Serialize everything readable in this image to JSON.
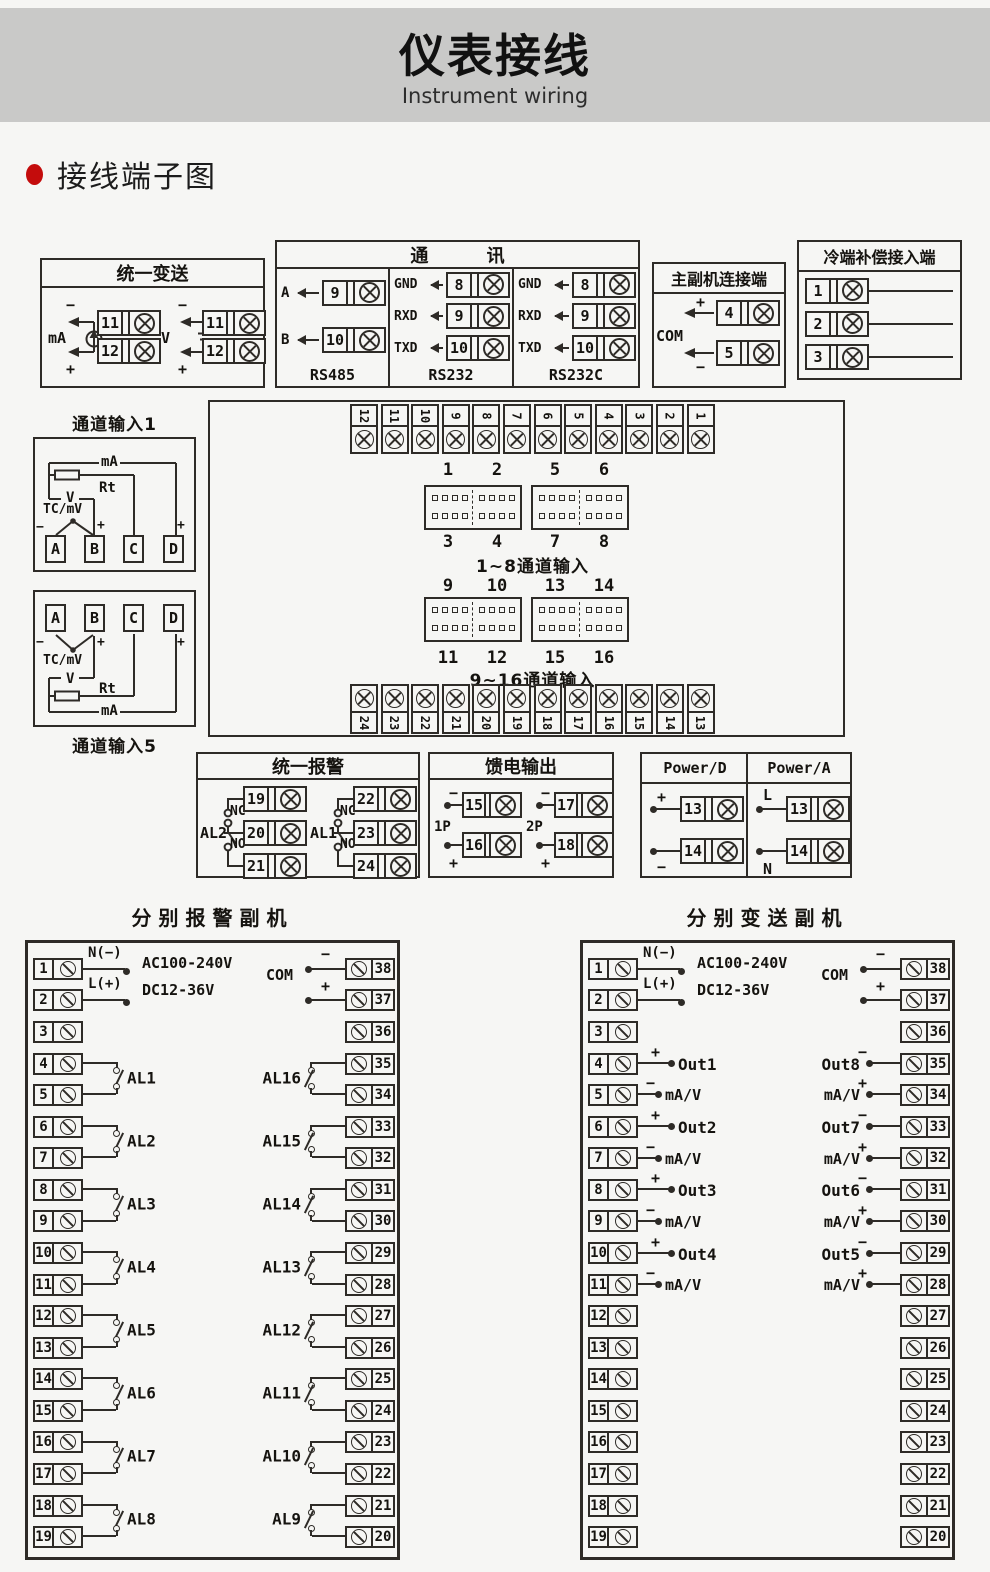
{
  "page": {
    "title": "仪表接线",
    "subtitle": "Instrument wiring",
    "section": "接线端子图"
  },
  "ut": {
    "title": "统一变送",
    "ma": "mA",
    "v": "V",
    "minus": "−",
    "plus": "+",
    "ma_terminals": [
      "11",
      "12"
    ],
    "v_terminals": [
      "11",
      "12"
    ]
  },
  "comm": {
    "title": "通 讯",
    "columns": [
      {
        "name": "RS485",
        "rows": [
          {
            "label": "A",
            "num": "9"
          },
          {
            "label": "B",
            "num": "10"
          }
        ]
      },
      {
        "name": "RS232",
        "rows": [
          {
            "label": "GND",
            "num": "8"
          },
          {
            "label": "RXD",
            "num": "9"
          },
          {
            "label": "TXD",
            "num": "10"
          }
        ]
      },
      {
        "name": "RS232C",
        "rows": [
          {
            "label": "GND",
            "num": "8"
          },
          {
            "label": "RXD",
            "num": "9"
          },
          {
            "label": "TXD",
            "num": "10"
          }
        ]
      }
    ]
  },
  "ms": {
    "title": "主副机连接端",
    "com": "COM",
    "plus": "+",
    "minus": "−",
    "terminals": [
      "4",
      "5"
    ]
  },
  "cc": {
    "title": "冷端补偿接入端",
    "rows": [
      {
        "label": "黑线",
        "num": "1"
      },
      {
        "label": "黄线",
        "num": "2"
      },
      {
        "label": "红线",
        "num": "3"
      }
    ]
  },
  "mb": {
    "top_strip": [
      "12",
      "11",
      "10",
      "9",
      "8",
      "7",
      "6",
      "5",
      "4",
      "3",
      "2",
      "1"
    ],
    "bottom_strip": [
      "24",
      "23",
      "22",
      "21",
      "20",
      "19",
      "18",
      "17",
      "16",
      "15",
      "14",
      "13"
    ],
    "upper": {
      "top_nums": [
        "1",
        "2",
        "5",
        "6"
      ],
      "bottom_nums": [
        "3",
        "4",
        "7",
        "8"
      ],
      "caption": "1~8通道输入"
    },
    "lower": {
      "top_nums": [
        "9",
        "10",
        "13",
        "14"
      ],
      "bottom_nums": [
        "11",
        "12",
        "15",
        "16"
      ],
      "caption": "9~16通道输入"
    }
  },
  "ch1": {
    "title": "通道输入1",
    "ma": "mA",
    "rt": "Rt",
    "v": "V",
    "tc": "TC/mV",
    "minus": "−",
    "plus": "+",
    "terminals": [
      "A",
      "B",
      "C",
      "D"
    ]
  },
  "ch5": {
    "title": "通道输入5",
    "ma": "mA",
    "rt": "Rt",
    "v": "V",
    "tc": "TC/mV",
    "minus": "−",
    "plus": "+",
    "terminals": [
      "A",
      "B",
      "C",
      "D"
    ]
  },
  "ua": {
    "title": "统一报警",
    "groups": [
      {
        "label": "AL2",
        "nc": "NC",
        "no": "NO",
        "terminals": [
          "19",
          "20",
          "21"
        ]
      },
      {
        "label": "AL1",
        "nc": "NC",
        "no": "NO",
        "terminals": [
          "22",
          "23",
          "24"
        ]
      }
    ]
  },
  "fo": {
    "title": "馈电输出",
    "minus": "−",
    "plus": "+",
    "groups": [
      {
        "label": "1P",
        "terminals": [
          "15",
          "16"
        ]
      },
      {
        "label": "2P",
        "terminals": [
          "17",
          "18"
        ]
      }
    ]
  },
  "pw": {
    "d_title": "Power/D",
    "a_title": "Power/A",
    "d": {
      "top_sign": "+",
      "bottom_sign": "−",
      "nums": [
        "13",
        "14"
      ]
    },
    "a": {
      "top_sign": "L",
      "bottom_sign": "N",
      "nums": [
        "13",
        "14"
      ]
    }
  },
  "as": {
    "title": "分别报警副机",
    "left_terminals": [
      "1",
      "2",
      "3",
      "4",
      "5",
      "6",
      "7",
      "8",
      "9",
      "10",
      "11",
      "12",
      "13",
      "14",
      "15",
      "16",
      "17",
      "18",
      "19"
    ],
    "right_terminals": [
      "38",
      "37",
      "36",
      "35",
      "34",
      "33",
      "32",
      "31",
      "30",
      "29",
      "28",
      "27",
      "26",
      "25",
      "24",
      "23",
      "22",
      "21",
      "20"
    ],
    "n": "N(−)",
    "l": "L(+)",
    "ac": "AC100-240V",
    "dc": "DC12-36V",
    "com": "COM",
    "minus": "−",
    "plus": "+",
    "left_alarms": [
      "AL1",
      "AL2",
      "AL3",
      "AL4",
      "AL5",
      "AL6",
      "AL7",
      "AL8"
    ],
    "right_alarms": [
      "AL16",
      "AL15",
      "AL14",
      "AL13",
      "AL12",
      "AL11",
      "AL10",
      "AL9"
    ]
  },
  "ts": {
    "title": "分别变送副机",
    "left_terminals": [
      "1",
      "2",
      "3",
      "4",
      "5",
      "6",
      "7",
      "8",
      "9",
      "10",
      "11",
      "12",
      "13",
      "14",
      "15",
      "16",
      "17",
      "18",
      "19"
    ],
    "right_terminals": [
      "38",
      "37",
      "36",
      "35",
      "34",
      "33",
      "32",
      "31",
      "30",
      "29",
      "28",
      "27",
      "26",
      "25",
      "24",
      "23",
      "22",
      "21",
      "20"
    ],
    "n": "N(−)",
    "l": "L(+)",
    "ac": "AC100-240V",
    "dc": "DC12-36V",
    "com": "COM",
    "minus": "−",
    "plus": "+",
    "left_outputs": [
      {
        "name": "Out1",
        "sub": "mA/V"
      },
      {
        "name": "Out2",
        "sub": "mA/V"
      },
      {
        "name": "Out3",
        "sub": "mA/V"
      },
      {
        "name": "Out4",
        "sub": "mA/V"
      }
    ],
    "right_outputs": [
      {
        "name": "Out8",
        "sub": "mA/V"
      },
      {
        "name": "Out7",
        "sub": "mA/V"
      },
      {
        "name": "Out6",
        "sub": "mA/V"
      },
      {
        "name": "Out5",
        "sub": "mA/V"
      }
    ]
  }
}
